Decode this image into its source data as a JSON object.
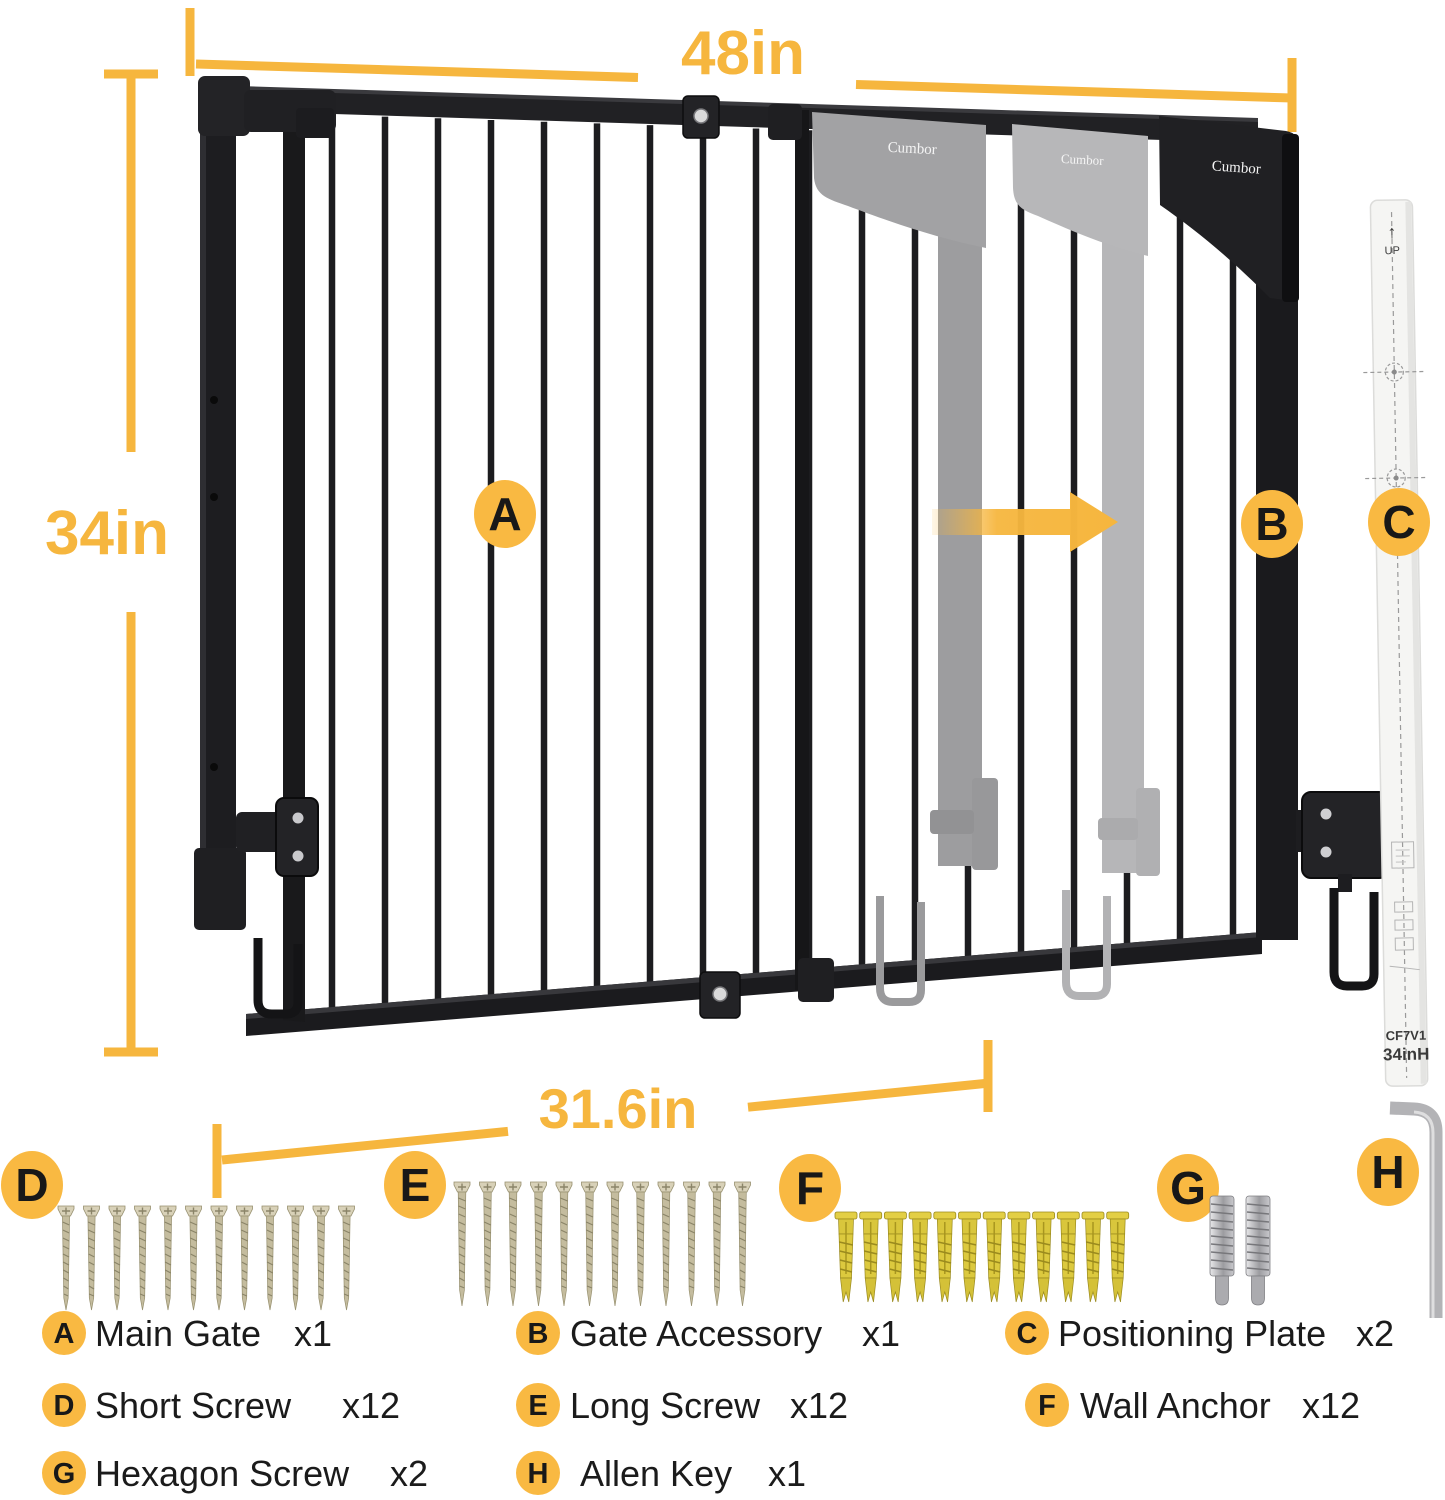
{
  "brand": "Cumbor",
  "colors": {
    "accent": "#F6B63E",
    "callout": "#F9B942",
    "gate_black": "#1c1c1f",
    "ghost_gray": "#a2a2a4",
    "ghost_light": "#b8b8ba",
    "screw_metal": "#d8d1b8",
    "anchor_yellow": "#ddc93e",
    "tool_metal": "#b3b3b6"
  },
  "dimensions": {
    "total_width": "48in",
    "height": "34in",
    "panel_width": "31.6in"
  },
  "plate": {
    "model": "CF7V1",
    "size_label": "34inH",
    "orientation_label": "UP"
  },
  "hardware": {
    "short_screw": {
      "count": 12
    },
    "long_screw": {
      "count": 12
    },
    "wall_anchor": {
      "count": 12
    },
    "hexagon_screw": {
      "count": 2
    },
    "allen_key": {
      "count": 1
    }
  },
  "legend": [
    {
      "key": "A",
      "name": "Main Gate",
      "qty": "x1"
    },
    {
      "key": "B",
      "name": "Gate Accessory",
      "qty": "x1"
    },
    {
      "key": "C",
      "name": "Positioning Plate",
      "qty": "x2"
    },
    {
      "key": "D",
      "name": "Short Screw",
      "qty": "x12"
    },
    {
      "key": "E",
      "name": "Long Screw",
      "qty": "x12"
    },
    {
      "key": "F",
      "name": "Wall Anchor",
      "qty": "x12"
    },
    {
      "key": "G",
      "name": "Hexagon Screw",
      "qty": "x2"
    },
    {
      "key": "H",
      "name": "Allen Key",
      "qty": "x1"
    }
  ]
}
